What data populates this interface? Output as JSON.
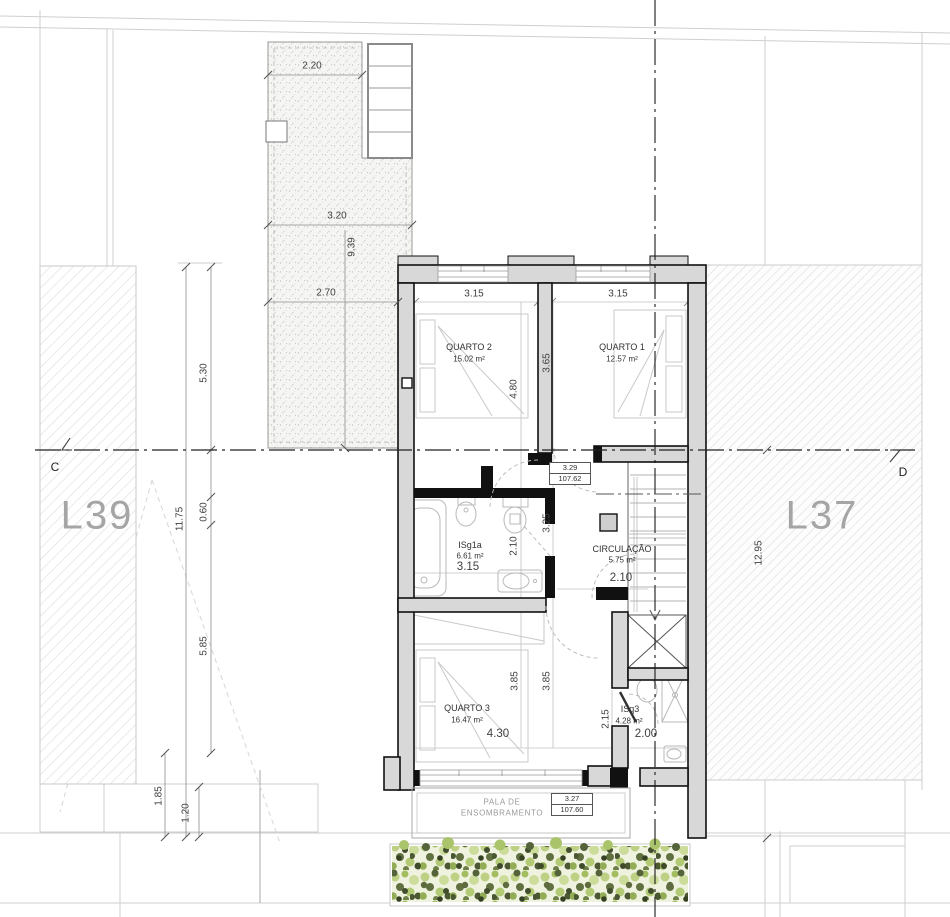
{
  "site": {
    "lot_left": "L39",
    "lot_right": "L37",
    "section_c": "C",
    "section_d": "D"
  },
  "rooms": {
    "quarto2": {
      "name": "QUARTO 2",
      "area": "15.02 m²"
    },
    "quarto1": {
      "name": "QUARTO 1",
      "area": "12.57 m²"
    },
    "isg1a": {
      "name": "ISg1a",
      "area": "6.61 m²"
    },
    "circulacao": {
      "name": "CIRCULAÇÃO",
      "area": "5.75 m²"
    },
    "quarto3": {
      "name": "QUARTO 3",
      "area": "16.47 m²"
    },
    "isq3": {
      "name": "ISq3",
      "area": "4.28 m²"
    }
  },
  "levels": {
    "upper": {
      "height": "3.29",
      "elevation": "107.62"
    },
    "lower": {
      "height": "3.27",
      "elevation": "107.60"
    }
  },
  "canopy": {
    "line1": "PALA DE",
    "line2": "ENSOMBRAMENTO"
  },
  "dims": {
    "terrace_top": "2.20",
    "terrace_mid": "3.20",
    "terrace_len": "9.39",
    "terrace_low": "2.70",
    "left_530": "5.30",
    "left_1175": "11.75",
    "left_060": "0.60",
    "left_585": "5.85",
    "left_185": "1.85",
    "left_120": "1.20",
    "right_1295": "12.95",
    "q2_w": "3.15",
    "q1_w": "3.15",
    "q2_d": "4.80",
    "q1_d": "3.65",
    "hall_d": "3.25",
    "bath_d": "2.10",
    "bath_w": "3.15",
    "circ_w": "2.10",
    "q3_d1": "3.85",
    "q3_d2": "3.85",
    "q3_w": "4.30",
    "isq3_d": "2.15",
    "isq3_w": "2.00"
  },
  "colors": {
    "wall_fill": "#d8d8d8",
    "wall_line": "#111111",
    "lot_label": "#a5a5a5",
    "hedge_light": "#b8cd7c",
    "hedge_dark": "#4c5831"
  }
}
